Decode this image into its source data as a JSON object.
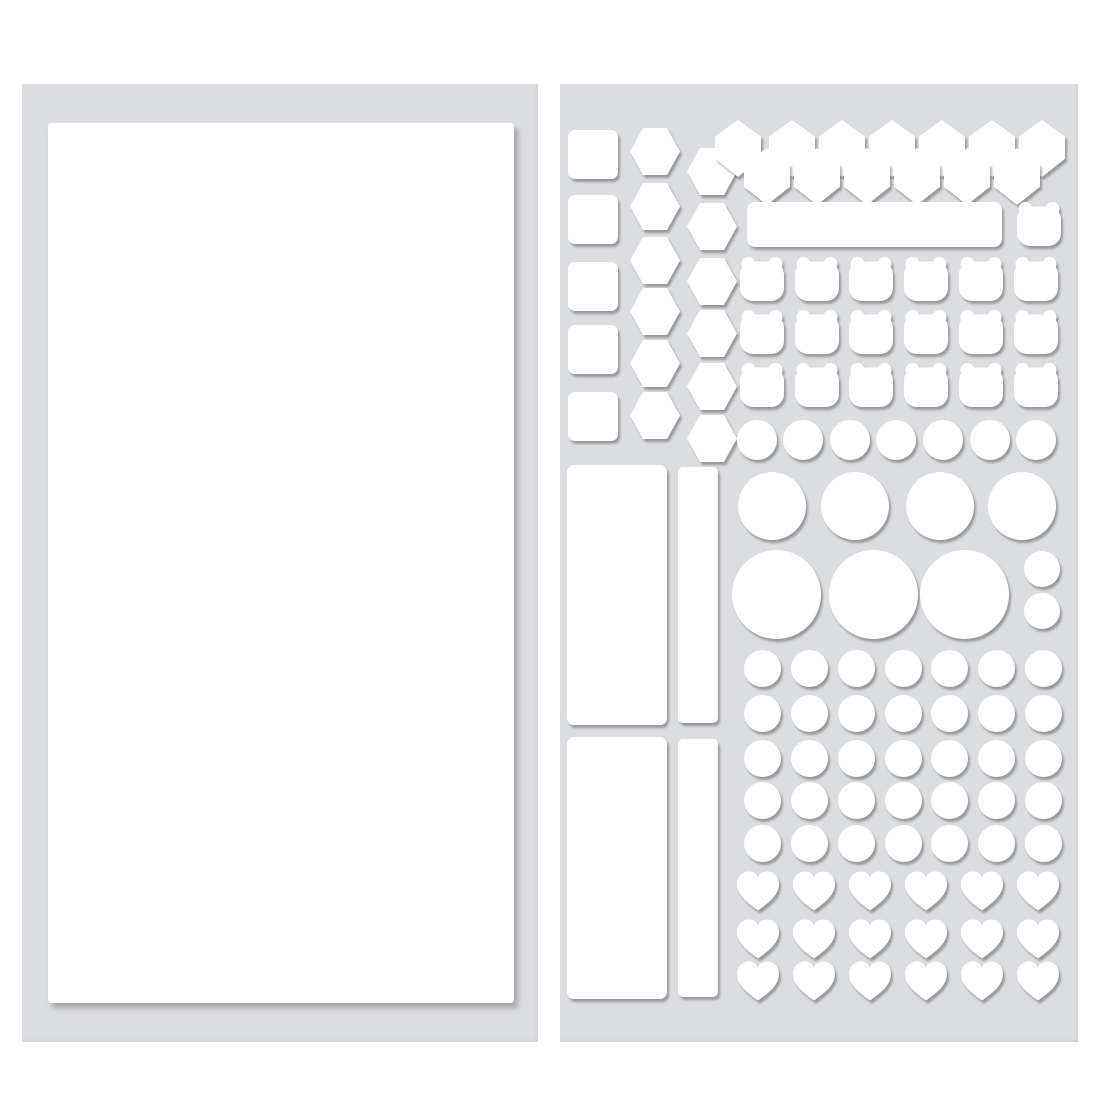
{
  "page": {
    "background": "#ffffff"
  },
  "colors": {
    "sheet": "#dcdddf",
    "sticker": "#ffffff",
    "shadow": "rgba(0,0,0,0.30)"
  },
  "left_sheet": {
    "x": 22,
    "y": 84,
    "w": 516,
    "h": 958,
    "groups": [
      {
        "item_name": "blank-sticker",
        "type": "rounded-rect",
        "w": 466,
        "h": 880,
        "r": 3,
        "big_shadow": true,
        "positions": [
          [
            26,
            39
          ]
        ]
      }
    ]
  },
  "right_sheet": {
    "x": 560,
    "y": 84,
    "w": 518,
    "h": 958,
    "groups": [
      {
        "item_name": "square-sticker",
        "type": "rounded-rect",
        "w": 50,
        "h": 49,
        "r": 7,
        "positions": [
          [
            8,
            46
          ],
          [
            8,
            111
          ],
          [
            8,
            178
          ],
          [
            8,
            241
          ],
          [
            8,
            308
          ]
        ]
      },
      {
        "item_name": "hexagon-sticker",
        "type": "hexagon-flat",
        "w": 50,
        "h": 47,
        "positions": [
          [
            70,
            44
          ],
          [
            70,
            99
          ],
          [
            70,
            153
          ],
          [
            70,
            204
          ],
          [
            70,
            256
          ],
          [
            70,
            308
          ]
        ]
      },
      {
        "item_name": "hexagon-sticker",
        "type": "hexagon-flat",
        "w": 50,
        "h": 47,
        "positions": [
          [
            127,
            64
          ],
          [
            127,
            119
          ],
          [
            127,
            174
          ],
          [
            127,
            226
          ],
          [
            127,
            279
          ],
          [
            127,
            331
          ]
        ]
      },
      {
        "item_name": "diamond-sticker",
        "type": "hexagon-pointy",
        "w": 46,
        "h": 57,
        "positions": [
          [
            155,
            36
          ],
          [
            209,
            36
          ],
          [
            259,
            36
          ],
          [
            309,
            36
          ],
          [
            359,
            36
          ],
          [
            409,
            36
          ],
          [
            459,
            36
          ]
        ]
      },
      {
        "item_name": "diamond-sticker",
        "type": "hexagon-pointy",
        "w": 46,
        "h": 57,
        "positions": [
          [
            184,
            64
          ],
          [
            234,
            64
          ],
          [
            284,
            64
          ],
          [
            334,
            64
          ],
          [
            384,
            64
          ],
          [
            434,
            64
          ]
        ]
      },
      {
        "item_name": "label-bar-sticker",
        "type": "rounded-rect",
        "w": 255,
        "h": 45,
        "r": 8,
        "positions": [
          [
            187,
            118
          ]
        ]
      },
      {
        "item_name": "bear-sticker",
        "type": "bear",
        "w": 48,
        "h": 47,
        "positions": [
          [
            455,
            116
          ],
          [
            178,
            171
          ],
          [
            233,
            171
          ],
          [
            287,
            171
          ],
          [
            342,
            171
          ],
          [
            397,
            171
          ],
          [
            452,
            171
          ],
          [
            178,
            224
          ],
          [
            233,
            224
          ],
          [
            287,
            224
          ],
          [
            342,
            224
          ],
          [
            397,
            224
          ],
          [
            452,
            224
          ],
          [
            178,
            277
          ],
          [
            233,
            277
          ],
          [
            287,
            277
          ],
          [
            342,
            277
          ],
          [
            397,
            277
          ],
          [
            452,
            277
          ]
        ]
      },
      {
        "item_name": "small-circle-sticker",
        "type": "circle",
        "w": 40,
        "h": 40,
        "positions": [
          [
            177,
            336
          ],
          [
            223,
            336
          ],
          [
            270,
            336
          ],
          [
            316,
            336
          ],
          [
            363,
            336
          ],
          [
            410,
            336
          ],
          [
            456,
            336
          ]
        ]
      },
      {
        "item_name": "medium-circle-sticker",
        "type": "circle",
        "w": 68,
        "h": 68,
        "positions": [
          [
            178,
            388
          ],
          [
            261,
            388
          ],
          [
            346,
            388
          ],
          [
            428,
            388
          ]
        ]
      },
      {
        "item_name": "large-circle-sticker",
        "type": "circle",
        "w": 89,
        "h": 89,
        "positions": [
          [
            172,
            466
          ],
          [
            269,
            466
          ],
          [
            360,
            466
          ]
        ]
      },
      {
        "item_name": "tiny-circle-sticker",
        "type": "circle",
        "w": 36,
        "h": 36,
        "positions": [
          [
            464,
            467
          ],
          [
            464,
            509
          ]
        ]
      },
      {
        "item_name": "dot-circle-sticker",
        "type": "circle",
        "w": 37,
        "h": 37,
        "positions": [
          [
            184,
            566
          ],
          [
            231,
            566
          ],
          [
            278,
            566
          ],
          [
            325,
            566
          ],
          [
            371,
            566
          ],
          [
            418,
            566
          ],
          [
            465,
            566
          ],
          [
            184,
            611
          ],
          [
            231,
            611
          ],
          [
            278,
            611
          ],
          [
            325,
            611
          ],
          [
            371,
            611
          ],
          [
            418,
            611
          ],
          [
            465,
            611
          ],
          [
            184,
            656
          ],
          [
            231,
            656
          ],
          [
            278,
            656
          ],
          [
            325,
            656
          ],
          [
            371,
            656
          ],
          [
            418,
            656
          ],
          [
            465,
            656
          ],
          [
            184,
            698
          ],
          [
            231,
            698
          ],
          [
            278,
            698
          ],
          [
            325,
            698
          ],
          [
            371,
            698
          ],
          [
            418,
            698
          ],
          [
            465,
            698
          ],
          [
            184,
            741
          ],
          [
            231,
            741
          ],
          [
            278,
            741
          ],
          [
            325,
            741
          ],
          [
            371,
            741
          ],
          [
            418,
            741
          ],
          [
            465,
            741
          ]
        ]
      },
      {
        "item_name": "heart-sticker",
        "type": "heart",
        "w": 46,
        "h": 42,
        "positions": [
          [
            175,
            786
          ],
          [
            231,
            786
          ],
          [
            287,
            786
          ],
          [
            343,
            786
          ],
          [
            399,
            786
          ],
          [
            455,
            786
          ],
          [
            175,
            834
          ],
          [
            231,
            834
          ],
          [
            287,
            834
          ],
          [
            343,
            834
          ],
          [
            399,
            834
          ],
          [
            455,
            834
          ],
          [
            175,
            876
          ],
          [
            231,
            876
          ],
          [
            287,
            876
          ],
          [
            343,
            876
          ],
          [
            399,
            876
          ],
          [
            455,
            876
          ]
        ]
      },
      {
        "item_name": "tall-rect-sticker",
        "type": "rounded-rect",
        "w": 100,
        "h": 260,
        "r": 7,
        "positions": [
          [
            7,
            381
          ]
        ]
      },
      {
        "item_name": "narrow-rect-sticker",
        "type": "rounded-rect",
        "w": 40,
        "h": 256,
        "r": 5,
        "positions": [
          [
            118,
            383
          ]
        ]
      },
      {
        "item_name": "tall-rect-sticker",
        "type": "rounded-rect",
        "w": 100,
        "h": 262,
        "r": 7,
        "positions": [
          [
            7,
            653
          ]
        ]
      },
      {
        "item_name": "narrow-rect-sticker",
        "type": "rounded-rect",
        "w": 40,
        "h": 258,
        "r": 5,
        "positions": [
          [
            118,
            655
          ]
        ]
      }
    ]
  }
}
